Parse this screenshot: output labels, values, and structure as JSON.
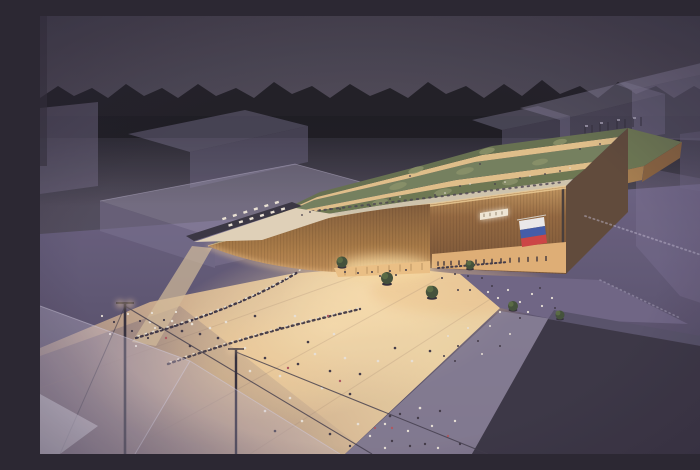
{
  "meta": {
    "title": "Pavilion night aerial rendering",
    "media_type": "architectural visualization, aerial dusk view"
  },
  "scene": {
    "caption": "Aerial dusk rendering of an illuminated timber pavilion with a sweeping curved facade, terraced green roof gardens and a rooftop promenade, a rooftop cafe terrace, a small glowing sign and a white-blue-red tricolor flag on the wooden facade, crowds and queues on a warmly lit timber plaza with round trees, light masts and translucent tensile canopies, surrounded by translucent massing blocks of neighboring buildings beneath a dark tree line."
  },
  "elements": {
    "sky": "dark dusk sky",
    "tree_line": "black silhouette of trees on the horizon",
    "context_buildings": "translucent lavender massing blocks",
    "pavilion": "curved timber pavilion with glowing edges",
    "roof_gardens": "parallel green landscaped roof bands with lit walkways",
    "terrace_cafe": "rooftop terrace with rows of tables",
    "facade_sign": "small glowing sign, text not legible",
    "flag": "white-blue-red tricolor flag on facade",
    "plaza": "warmly lit timber boardwalk with visitors and queues",
    "trees": "round trees in dark planters",
    "canopies": "translucent tensile canopies with masts and cables",
    "dark_block": "large dark context volume in the foreground right"
  },
  "palette": {
    "sky_top": "#45414b",
    "sky_bottom": "#564f61",
    "treeline": "#1b1a1e",
    "ghost_violet": "#8b83a3",
    "ground_top": "#6a6180",
    "ground_bottom": "#4a4359",
    "deck_bright": "#f1d6a2",
    "deck_glow": "#ffe3ae",
    "wood_dark": "#77522f",
    "wood_mid": "#a9793f",
    "wood_glow": "#d9a763",
    "roof_green": "#6c784d",
    "walk_light": "#d4c9ad",
    "glow_strip": "#e7c488",
    "glass_glow": "#f2c583",
    "sign_glow": "#f7eed8",
    "flag_white": "#f2f1ef",
    "flag_blue": "#3f5ba9",
    "flag_red": "#d2413e",
    "shadow_box": "#37323f",
    "path_gray": "#8b8298",
    "canopy": "#cfc8dc",
    "tree_green": "#3f4f33",
    "people_light": "#efe8da",
    "people_dark": "#3e3742",
    "people_red": "#b0565c"
  },
  "flag": {
    "stripes": [
      "#f2f1ef",
      "#3f5ba9",
      "#d2413e"
    ]
  }
}
